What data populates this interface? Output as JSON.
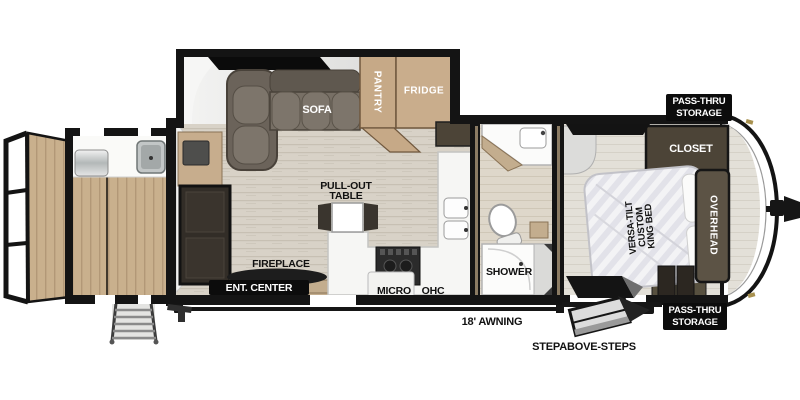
{
  "title": "Travel Trailer Floor Plan",
  "palette": {
    "wall": "#141414",
    "wood_tan": "#c9b08d",
    "cabinet_tan": "#c6a987",
    "cabinet_dark": "#4c4437",
    "floor_main": "#d8d2c7",
    "floor_bedroom": "#e3e0d8",
    "sofa": "#776f65",
    "label_bg": "#0c0c0c",
    "label_text": "#ffffff"
  },
  "living": {
    "sofa": "SOFA",
    "pantry": "PANTRY",
    "fridge": "FRIDGE",
    "fireplace": "FIREPLACE",
    "ent_center": "ENT. CENTER"
  },
  "kitchen": {
    "pull_out_line1": "PULL-OUT",
    "pull_out_line2": "TABLE",
    "micro": "MICRO",
    "ohc": "OHC"
  },
  "bathroom": {
    "shower": "SHOWER"
  },
  "bedroom": {
    "closet": "CLOSET",
    "overhead": "OVERHEAD",
    "bed_line1": "VERSA-TILT",
    "bed_line2": "CUSTOM",
    "bed_line3": "KING BED"
  },
  "exterior": {
    "awning": "18' AWNING",
    "steps": "STEPABOVE-STEPS",
    "pass_thru_front_line1": "PASS-THRU",
    "pass_thru_front_line2": "STORAGE",
    "pass_thru_lower_line1": "PASS-THRU",
    "pass_thru_lower_line2": "STORAGE"
  }
}
